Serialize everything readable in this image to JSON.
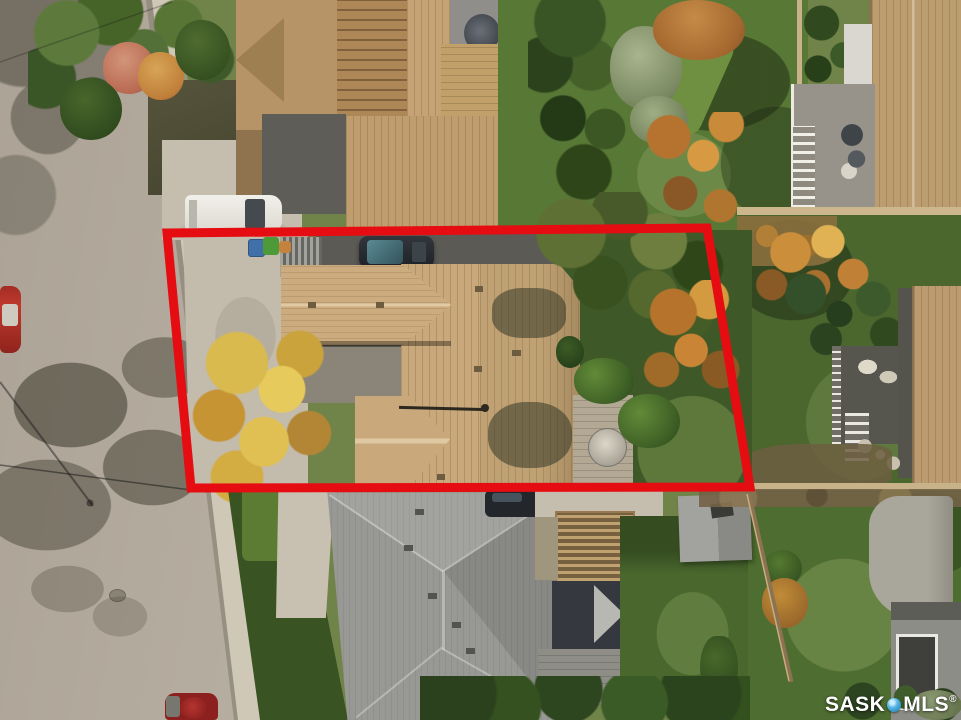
{
  "image": {
    "kind": "aerial drone photograph",
    "description": "Top-down autumn aerial view of a residential lot outlined in red: street and sidewalk at left, subject house with tan shingle roof and driveway, backyard trees in fall colours, neighbouring houses, decks, sheds and lawns around it"
  },
  "overlay": {
    "outline_points": "167,233 707,228 750,487 191,488",
    "outline_color": "#e60d12",
    "outline_stroke_width": 9
  },
  "watermark": {
    "left": "SASK",
    "right": "MLS",
    "registered": "®",
    "icon": "location-pin",
    "icon_color": "#3fa3d9",
    "text_color": "#ffffff"
  }
}
